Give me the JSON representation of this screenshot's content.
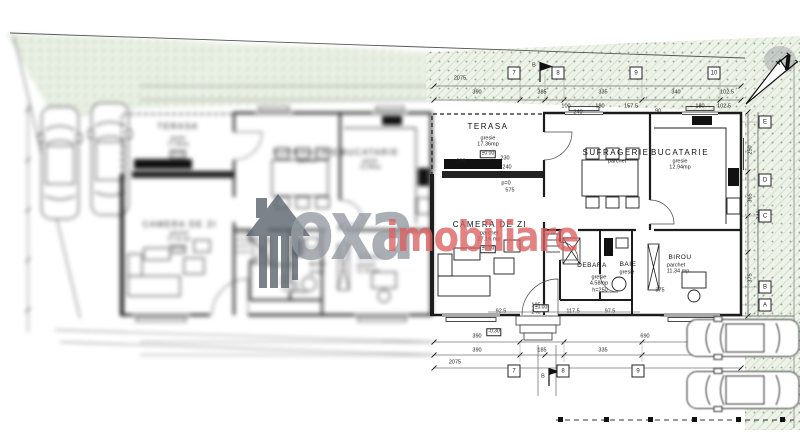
{
  "watermark": {
    "brand_gray": "oxa",
    "brand_red": "imobiliare",
    "gray_color": "#969ca3",
    "red_color": "#db5f5f"
  },
  "rooms": {
    "terasa": {
      "name": "TERASA",
      "finish": "gresie",
      "area": "17.36mp",
      "level": "±0.00"
    },
    "sufragerie": {
      "name": "SUFRAGERIE",
      "finish": "parchet"
    },
    "bucatarie": {
      "name": "BUCATARIE",
      "finish": "gresie",
      "area": "12.94mp"
    },
    "camera_de_zi": {
      "name": "CAMERA DE ZI",
      "finish": "parchet",
      "area": "27.16 mp",
      "level": "±0.00"
    },
    "debara": {
      "name": "DEBARA",
      "finish": "gresie",
      "area": "4.58mp",
      "height": "h=250"
    },
    "baie": {
      "name": "BAIE",
      "finish": "gresie"
    },
    "birou": {
      "name": "BIROU",
      "finish": "parchet",
      "area": "11.34 mp"
    }
  },
  "grid": {
    "top": [
      "7",
      "8",
      "9",
      "10"
    ],
    "bottom": [
      "7",
      "8",
      "9"
    ],
    "right": [
      "E",
      "D",
      "C",
      "B",
      "A"
    ]
  },
  "dims": {
    "top_total": "2075",
    "top_chain": [
      "390",
      "385",
      "335",
      "340",
      "102.5"
    ],
    "top_sub": [
      "100",
      "240",
      "180",
      "157.5",
      "90",
      "180",
      "102.5"
    ],
    "terasa_dims": [
      "290",
      "230",
      "240",
      "p=0",
      "575"
    ],
    "right_chain": [
      "250",
      "365",
      "340",
      "375"
    ],
    "bottom_row1": [
      "390",
      "690"
    ],
    "bottom_row2": [
      "390",
      "185",
      "335"
    ],
    "bottom_total": "2075",
    "entrance_row": [
      "92.5",
      "185",
      "248",
      "117.5",
      "97.5",
      "375"
    ]
  },
  "levels": {
    "zero": "±0.00",
    "minus": "-0.30"
  },
  "markers": {
    "flag": "B",
    "north": "N"
  }
}
